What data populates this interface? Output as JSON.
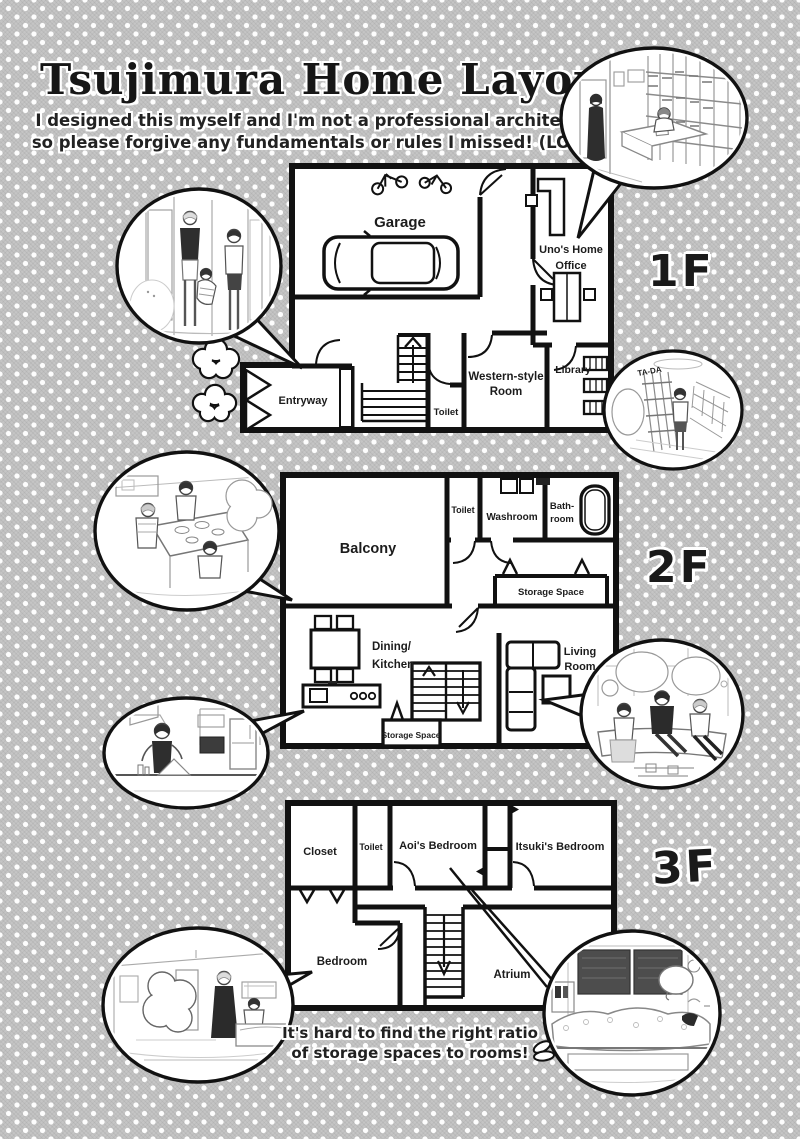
{
  "header": {
    "title": "Tsujimura Home Layout",
    "subtitle_line1": "I designed this myself and I'm not a professional architect,",
    "subtitle_line2": "so please forgive any fundamentals or rules I missed! (LOL)"
  },
  "floors": [
    {
      "label": "1F",
      "rooms": {
        "garage": "Garage",
        "office_l1": "Uno's Home",
        "office_l2": "Office",
        "entryway": "Entryway",
        "toilet": "Toilet",
        "western_l1": "Western-style",
        "western_l2": "Room",
        "library": "Library"
      }
    },
    {
      "label": "2F",
      "rooms": {
        "balcony": "Balcony",
        "toilet": "Toilet",
        "washroom": "Washroom",
        "bathroom_l1": "Bath-",
        "bathroom_l2": "room",
        "storage_upper": "Storage Space",
        "dining_l1": "Dining/",
        "dining_l2": "Kitchen",
        "living_l1": "Living",
        "living_l2": "Room",
        "storage_lower": "Storage Space"
      }
    },
    {
      "label": "3F",
      "rooms": {
        "closet": "Closet",
        "toilet": "Toilet",
        "aoi": "Aoi's Bedroom",
        "itsuki": "Itsuki's Bedroom",
        "bedroom": "Bedroom",
        "atrium": "Atrium"
      }
    }
  ],
  "insets": {
    "library_sfx": "TA-DA"
  },
  "caption": {
    "line1": "It's hard to find the right ratio",
    "line2": "of storage spaces to rooms!"
  },
  "colors": {
    "background": "#c5c5c5",
    "wall": "#111111",
    "room_fill": "#ffffff",
    "ink": "#1a1a1a"
  }
}
